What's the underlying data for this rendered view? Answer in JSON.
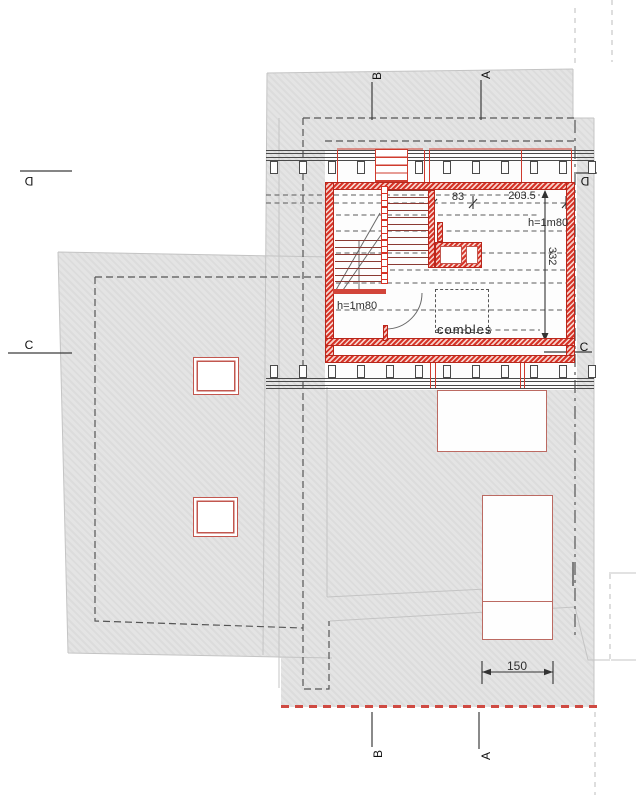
{
  "meta": {
    "drawing_type": "architectural floor plan",
    "floor_shown": "combles"
  },
  "labels": {
    "room": "combles",
    "dim_width_left": "83",
    "dim_width_right": "203.5",
    "dim_height": "332",
    "dim_bottom": "150",
    "height_note_left": "h=1m80",
    "height_note_right": "h=1m80"
  },
  "section_markers": {
    "top_b": "B",
    "top_a": "A",
    "bottom_b": "B",
    "bottom_a": "A",
    "left_d": "D",
    "left_c": "C",
    "right_d": "D",
    "right_c": "C"
  },
  "colors": {
    "wall_red": "#d63327",
    "thin_outline_red": "#bc6a62",
    "boundary_dashed_red": "#cf4a42",
    "roof_gray": "#e4e4e4",
    "line_dark": "#4a4a4a"
  }
}
